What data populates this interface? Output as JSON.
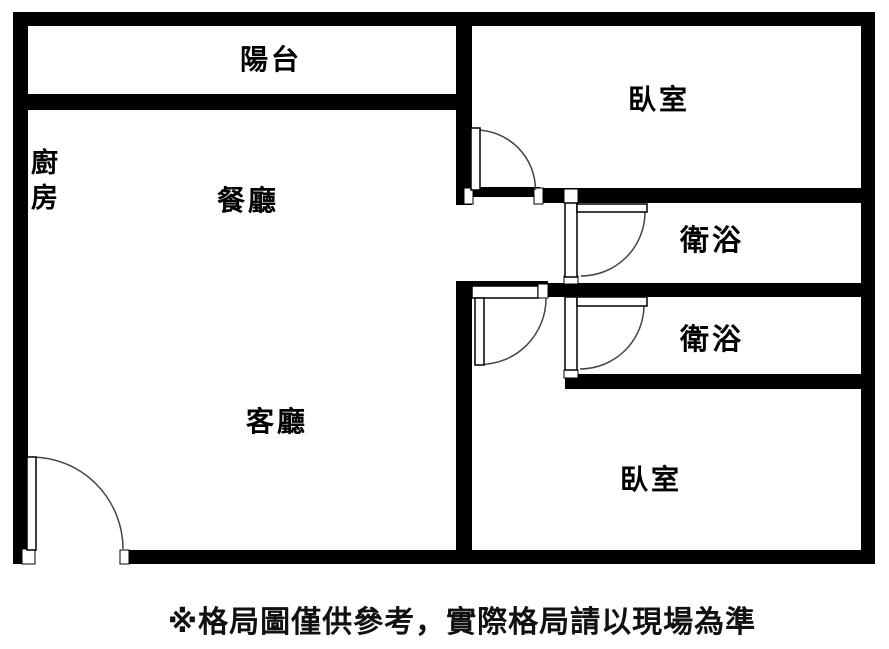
{
  "floor_plan": {
    "labels": {
      "balcony": "陽台",
      "kitchen": "廚房",
      "dining_room": "餐廳",
      "living_room": "客廳",
      "bedroom_top": "臥室",
      "bathroom_upper": "衛浴",
      "bathroom_lower": "衛浴",
      "bedroom_bottom": "臥室"
    },
    "disclaimer": "※格局圖僅供參考，實際格局請以現場為準",
    "colors": {
      "wall": "#000000",
      "background": "#ffffff",
      "text": "#000000",
      "door_arc": "#444444"
    }
  }
}
